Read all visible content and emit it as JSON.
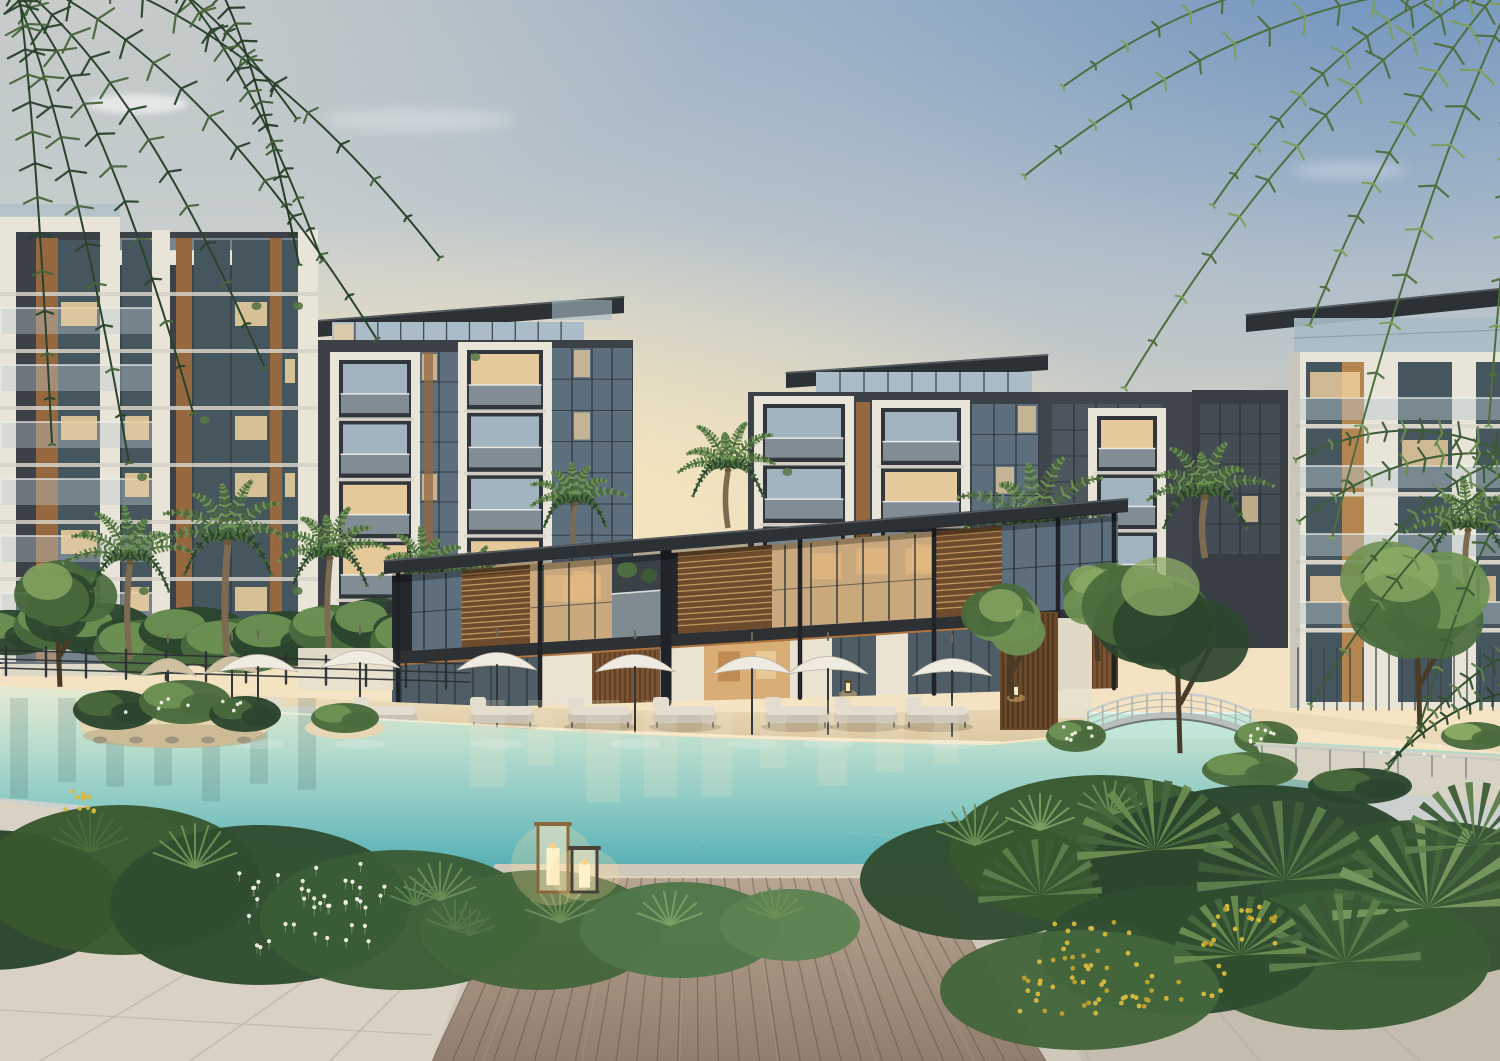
{
  "scene": {
    "description": "Twilight architectural rendering of a modern residential community: glass-and-wood apartment buildings around a two-storey clubhouse pavilion, a turquoise lagoon pool with sandy beach edge, white patio umbrellas with daybeds, an arched footbridge, lush palm landscaping, a timber sun deck with candle lanterns and stone paving in the foreground",
    "time_of_day": "dusk",
    "counts": {
      "white_umbrellas": 7,
      "tan_umbrellas": 2,
      "daybeds": 8,
      "deck_lanterns": 2,
      "footbridges": 1,
      "palm_trees": 10
    },
    "umbrellas_white": [
      {
        "x": 258,
        "y": 646
      },
      {
        "x": 360,
        "y": 642
      },
      {
        "x": 497,
        "y": 644
      },
      {
        "x": 635,
        "y": 646
      },
      {
        "x": 752,
        "y": 648
      },
      {
        "x": 828,
        "y": 648
      },
      {
        "x": 952,
        "y": 650
      }
    ],
    "umbrellas_tan": [
      {
        "x": 168,
        "y": 650
      },
      {
        "x": 232,
        "y": 648
      }
    ],
    "daybeds": [
      297,
      385,
      502,
      600,
      685,
      797,
      866,
      937
    ],
    "deck_lanterns": [
      {
        "x": 538,
        "y": 824,
        "w": 30,
        "h": 68,
        "frame": "bronze"
      },
      {
        "x": 572,
        "y": 848,
        "w": 25,
        "h": 44,
        "frame": "dark"
      }
    ],
    "palms": [
      {
        "x": 130,
        "y": 560,
        "s": 0.95,
        "t": 660
      },
      {
        "x": 228,
        "y": 540,
        "s": 1.05,
        "t": 668
      },
      {
        "x": 330,
        "y": 556,
        "s": 0.9,
        "t": 662
      },
      {
        "x": 425,
        "y": 572,
        "s": 0.8,
        "t": 650
      },
      {
        "x": 472,
        "y": 584,
        "s": 0.65,
        "t": 640
      },
      {
        "x": 575,
        "y": 502,
        "s": 0.75,
        "t": 556
      },
      {
        "x": 728,
        "y": 468,
        "s": 0.85,
        "t": 528
      },
      {
        "x": 1035,
        "y": 528,
        "s": 1.3,
        "t": 700
      },
      {
        "x": 1205,
        "y": 495,
        "s": 1.0,
        "t": 558
      },
      {
        "x": 1468,
        "y": 528,
        "s": 0.9,
        "t": 588
      }
    ],
    "footbridge": {
      "x1": 1088,
      "x2": 1252,
      "deck_y": 736,
      "apex_y": 700
    }
  },
  "palette": {
    "sky_top_right": "#7d9dc0",
    "sky_grey": "#c9cfd0",
    "sky_mid": "#d9d8cf",
    "sky_horizon": "#f3e1c1",
    "sun_glow": "#f9e8c2",
    "cloud": "#ffffff",
    "roof_dark": "#2c3135",
    "facade_dark": "#3b4147",
    "facade_dark2": "#343a40",
    "facade_white": "#e9e4d8",
    "facade_white_shade": "#d7d2c6",
    "glass_cool": "#a9bcc7",
    "glass_dark": "#5d6f7d",
    "glass_deep": "#46565f",
    "glass_lit": "#f0d2a0",
    "interior_warm": "#e2b781",
    "wood_accent": "#96683f",
    "wood_dark": "#6e4b2c",
    "louver_light": "#c99f63",
    "sand": "#e9d9b8",
    "sand_shade": "#ddc9a4",
    "water_far": "#e7ebd2",
    "water_mid1": "#b5dccc",
    "water_mid2": "#86c8c2",
    "water_near": "#57b1b6",
    "water_deep": "#3f9aa4",
    "umbrella_white": "#efebe1",
    "umbrella_tan": "#cfc0a2",
    "cushion": "#e3ddd0",
    "frame_grey": "#8b857a",
    "deck_near": "#9b8878",
    "deck_far": "#b7a492",
    "coping": "#cfc7b7",
    "paving": "#d9d2c3",
    "paving_shade": "#c4bcac",
    "joint": "#b3ab9b",
    "leaf_dark": "#2b452d",
    "leaf": "#4a6a3c",
    "leaf_light": "#6f9354",
    "leaf_bright": "#8fae67",
    "trunk": "#7d6b51",
    "flower_white": "#f2f1e8",
    "flower_yellow": "#d9b93c",
    "bronze": "#8a683c",
    "lantern_dark": "#4a4238",
    "candle": "#fff1c9",
    "flame": "#ffcf7e",
    "railing": "#2c3033",
    "bridge_rail": "#c3c8c5",
    "fence": "#3d4347"
  }
}
